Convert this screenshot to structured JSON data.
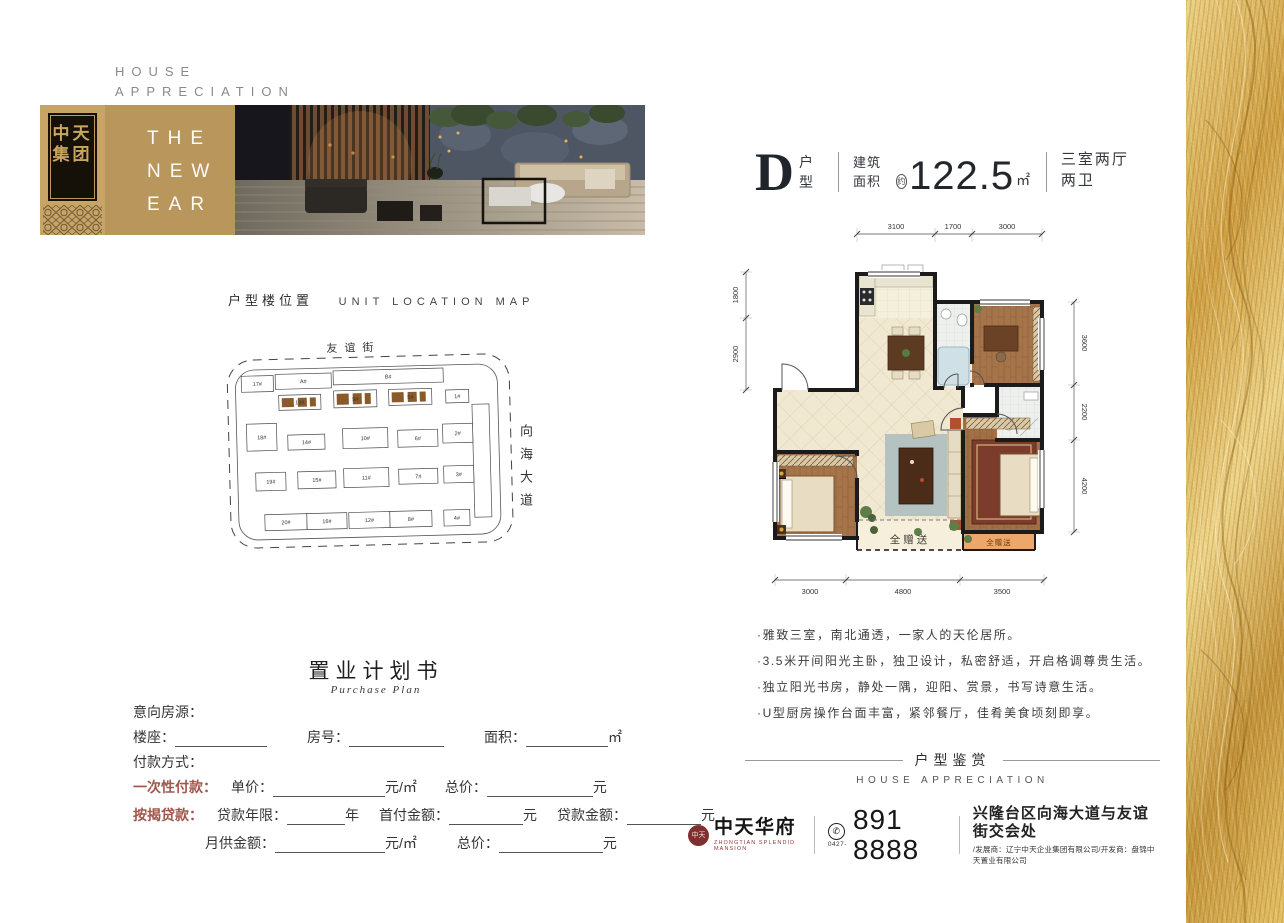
{
  "hero": {
    "kicker_line1": "HOUSE",
    "kicker_line2": "APPRECIATION",
    "logo_top": "中天",
    "logo_bottom": "集团",
    "banner_line1": "THE",
    "banner_line2": "NEW",
    "banner_line3": "EAR"
  },
  "unit_header": {
    "letter": "D",
    "type_label": "户型",
    "area_label": "建筑面积",
    "approx": "约",
    "area_value": "122.5",
    "area_unit": "㎡",
    "rooms": "三室两厅两卫"
  },
  "floorplan": {
    "dims_top": [
      "3100",
      "1700",
      "3000"
    ],
    "dims_left": [
      "1800",
      "2900"
    ],
    "dims_right": [
      "3600",
      "2200",
      "4200"
    ],
    "dims_bottom": [
      "3000",
      "4800",
      "3500"
    ],
    "gift_center": "全赠送",
    "gift_right": "全赠送"
  },
  "features": {
    "items": [
      "·雅致三室，南北通透，一家人的天伦居所。",
      "·3.5米开间阳光主卧，独卫设计，私密舒适，开启格调尊贵生活。",
      "·独立阳光书房，静处一隅，迎阳、赏景，书写诗意生活。",
      "·U型厨房操作台面丰富，紧邻餐厅，佳肴美食顷刻即享。"
    ]
  },
  "appreciation": {
    "cn": "户型鉴赏",
    "en": "HOUSE APPRECIATION"
  },
  "location_map": {
    "title_cn": "户型楼位置",
    "title_en": "UNIT LOCATION MAP",
    "street_top": "友谊街",
    "street_right": "向海大道",
    "building_labels": [
      "17#",
      "A#",
      "B#",
      "13#",
      "9#",
      "5#",
      "1#",
      "18#",
      "14#",
      "10#",
      "6#",
      "2#",
      "19#",
      "15#",
      "11#",
      "7#",
      "3#",
      "20#",
      "16#",
      "12#",
      "8#",
      "4#"
    ]
  },
  "purchase_plan": {
    "title": "置业计划书",
    "subtitle": "Purchase Plan",
    "intent": "意向房源：",
    "building": "楼座：",
    "room": "房号：",
    "area": "面积：",
    "sqm": "㎡",
    "payment": "付款方式：",
    "onetime": "一次性付款：",
    "unit_price": "单价：",
    "yuan_per_sqm": "元/㎡",
    "total": "总价：",
    "yuan": "元",
    "mortgage": "按揭贷款：",
    "loan_years": "贷款年限：",
    "year": "年",
    "down_payment": "首付金额：",
    "loan_amount": "贷款金额：",
    "monthly": "月供金额："
  },
  "contact": {
    "seal": "中天",
    "brand_cn": "中天华府",
    "brand_en": "ZHONGTIAN SPLENDID MANSION",
    "area_code": "0427-",
    "phone": "891 8888",
    "address": "兴隆台区向海大道与友谊街交会处",
    "developers": "/发展商：辽宁中天企业集团有限公司/开发商：盘锦中天置业有限公司"
  },
  "colors": {
    "gold_band": "#b9975c",
    "accent_red": "#a0564b",
    "seal_red": "#7e2f2f",
    "wall": "#1b1b1b",
    "gift_orange": "#eda76a",
    "highlight_brown": "#8a5a2b"
  }
}
